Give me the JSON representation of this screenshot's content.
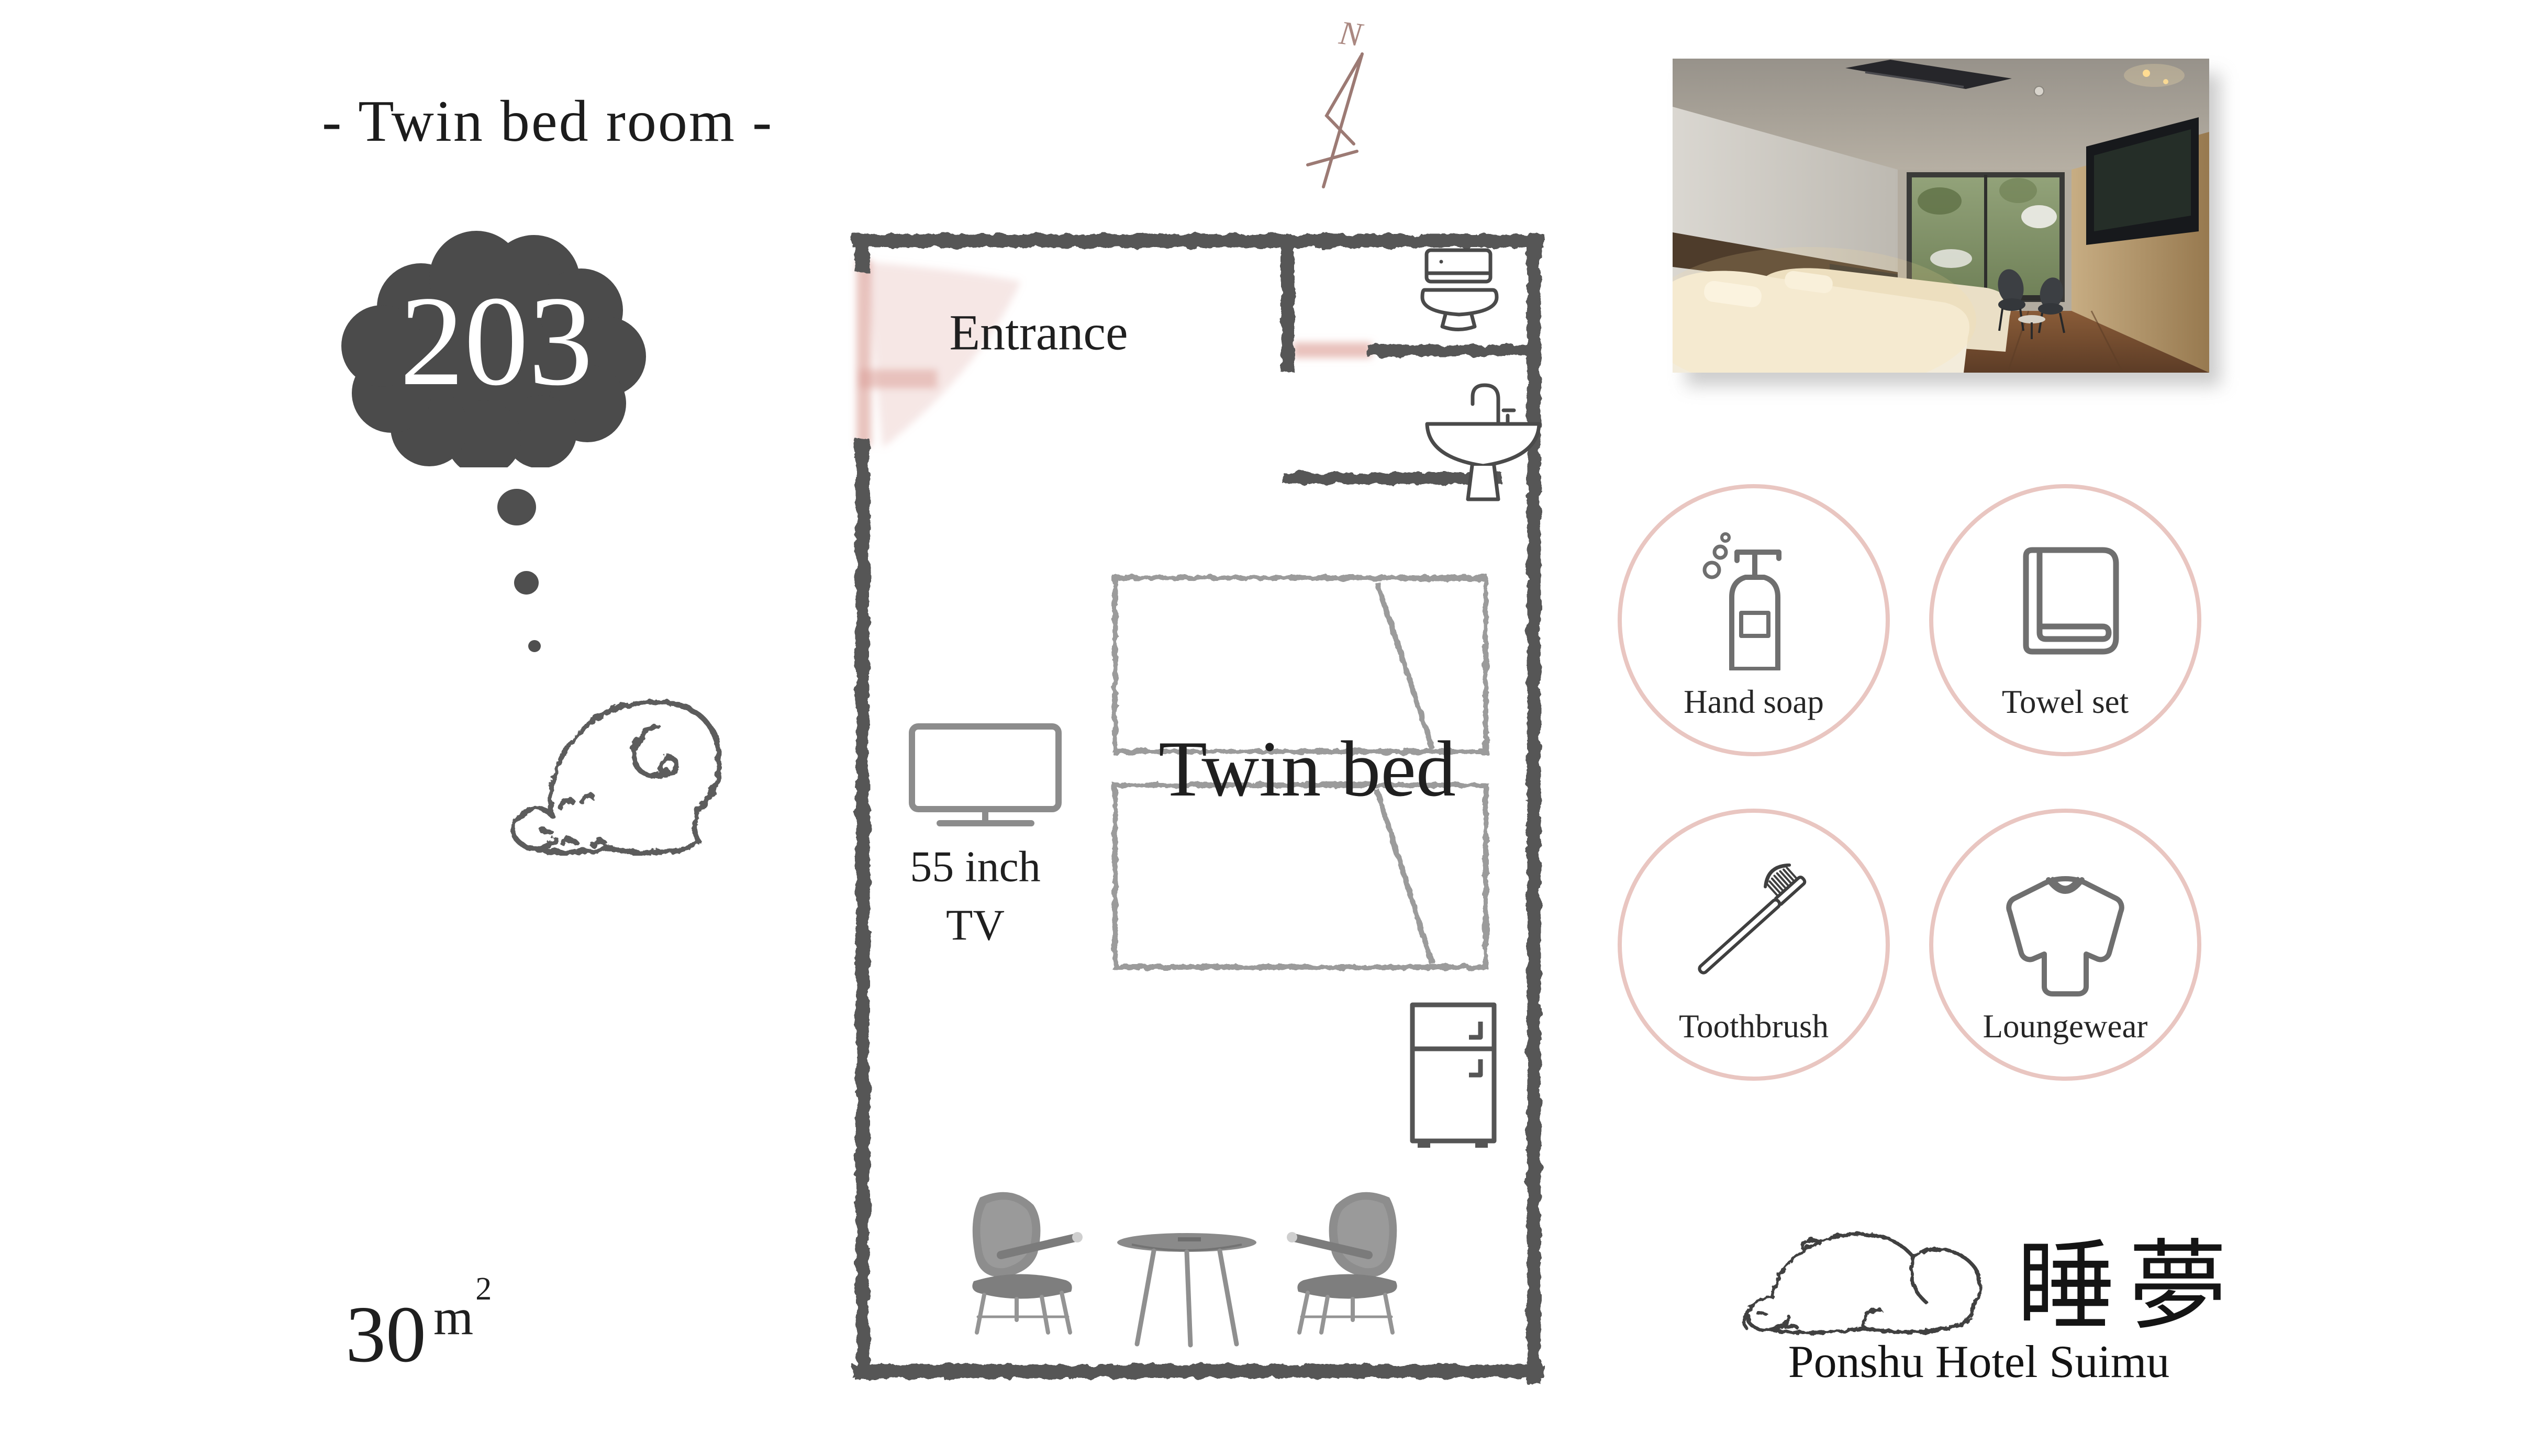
{
  "poster": {
    "title": "- Twin bed room -",
    "room_number": "203",
    "area": {
      "value": "30",
      "unit": "m",
      "exponent": "2"
    }
  },
  "floor_plan": {
    "entrance_label": "Entrance",
    "bed_label": "Twin bed",
    "tv_line1": "55 inch",
    "tv_line2": "TV",
    "compass_label": "N",
    "fixtures": [
      "toilet",
      "sink",
      "tv",
      "fridge",
      "two chairs",
      "round table",
      "twin beds",
      "entrance door"
    ]
  },
  "amenities": [
    {
      "label": "Hand soap",
      "icon": "soap-dispenser-icon"
    },
    {
      "label": "Towel set",
      "icon": "towel-icon"
    },
    {
      "label": "Toothbrush",
      "icon": "toothbrush-icon"
    },
    {
      "label": "Loungewear",
      "icon": "loungewear-icon"
    }
  ],
  "brand": {
    "kanji": "睡夢",
    "name": "Ponshu Hotel Suimu"
  },
  "colors": {
    "accent_pink": "#e9c6c1",
    "door_pink": "#dfa8a0",
    "cloud_gray": "#4b4b4b",
    "wall_sketch_gray": "#575757",
    "bed_sketch_gray": "#9b9b9b",
    "icon_gray": "#6f6f6f",
    "compass_brown": "#9c7a74",
    "text_black": "#1c1c1c"
  }
}
